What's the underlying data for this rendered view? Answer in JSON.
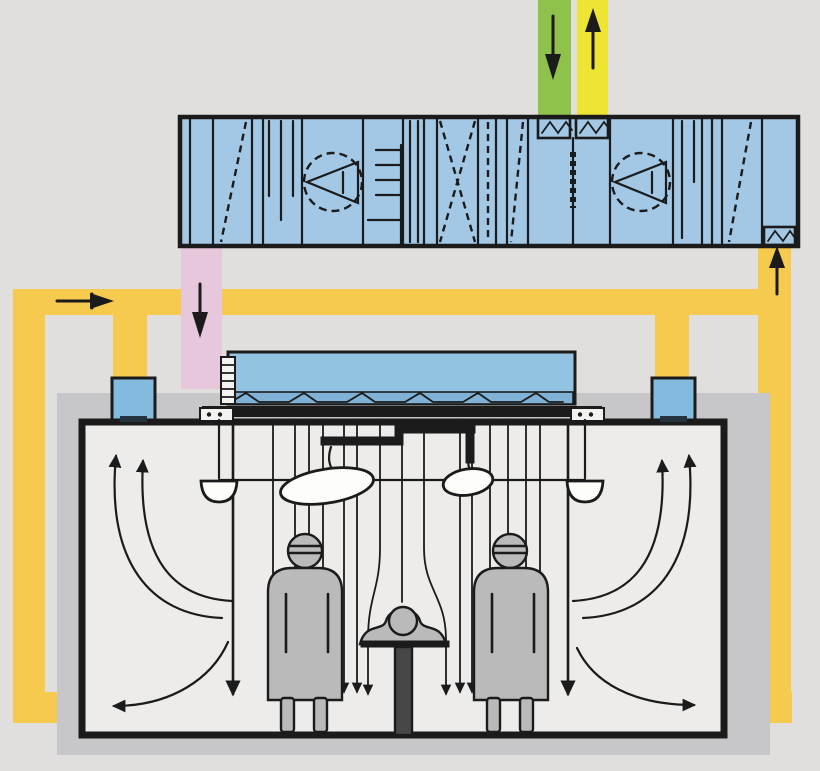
{
  "title": "Operating room air-conditioning schematic: air handling unit with fresh-air and exhaust ducts, recirculation loop and laminar-airflow ceiling above the surgical team",
  "colors": {
    "background": "#e0dfdd",
    "line": "#1b1b1b",
    "ahu_body": "#a2c8e6",
    "plenum_blue": "#93c3e3",
    "filter_strip_blue": "#7fb2d6",
    "exhaust_box_blue": "#83bade",
    "fresh_air_green": "#8fc24a",
    "exhaust_air_yellow": "#eee434",
    "return_duct_yellow": "#f6c94f",
    "supply_duct_pink": "#e7c7db",
    "room_shadow": "#c7c7ca",
    "room_interior": "#edecea",
    "figure_gray": "#bababa",
    "lamp_white": "#fdfdfa",
    "pedestal_gray": "#474747",
    "slot_dark": "#26333e",
    "bracket_white": "#f2f2f0"
  },
  "components": {
    "air_handling_unit": "Air handling unit",
    "fresh_air_duct": "Fresh air intake duct",
    "exhaust_air_duct": "Exhaust air duct",
    "supply_air_duct": "Supply air drop to plenum",
    "return_air_loop": "Return / recirculation duct loop",
    "hepa_plenum": "Laminar-flow supply plenum with HEPA filter bank",
    "laminar_diffuser": "Laminar airflow ceiling diffuser",
    "ceiling_exhaust_left": "Ceiling return grille left",
    "ceiling_exhaust_right": "Ceiling return grille right",
    "operating_room": "Operating room",
    "surgeon_left": "Surgeon left",
    "surgeon_right": "Surgeon right",
    "patient": "Patient on operating table",
    "operating_table": "Operating table",
    "surgical_light_main": "Main surgical light",
    "surgical_light_satellite": "Satellite surgical light",
    "ceiling_lamp_left": "Ceiling lamp left",
    "ceiling_lamp_right": "Ceiling lamp right",
    "supply_fan": "Supply air fan",
    "return_fan": "Extract air fan",
    "heat_exchanger": "Heat recovery exchanger",
    "heating_coil": "Heating and cooling coil",
    "filters": "Air filter stages",
    "silencers": "Sound attenuators",
    "dampers": "Air dampers"
  },
  "airflow": {
    "arrows": [
      {
        "name": "fresh-air",
        "direction": "down"
      },
      {
        "name": "exhaust-air",
        "direction": "up"
      },
      {
        "name": "supply-to-plenum",
        "direction": "down"
      },
      {
        "name": "return-header",
        "direction": "right"
      },
      {
        "name": "return-riser-to-ahu",
        "direction": "up"
      },
      {
        "name": "laminar-downflow",
        "direction": "down"
      },
      {
        "name": "wall-recirculation-left",
        "direction": "up"
      },
      {
        "name": "wall-recirculation-right",
        "direction": "up"
      },
      {
        "name": "floor-extract-left",
        "direction": "left"
      },
      {
        "name": "floor-extract-right",
        "direction": "right"
      }
    ]
  }
}
